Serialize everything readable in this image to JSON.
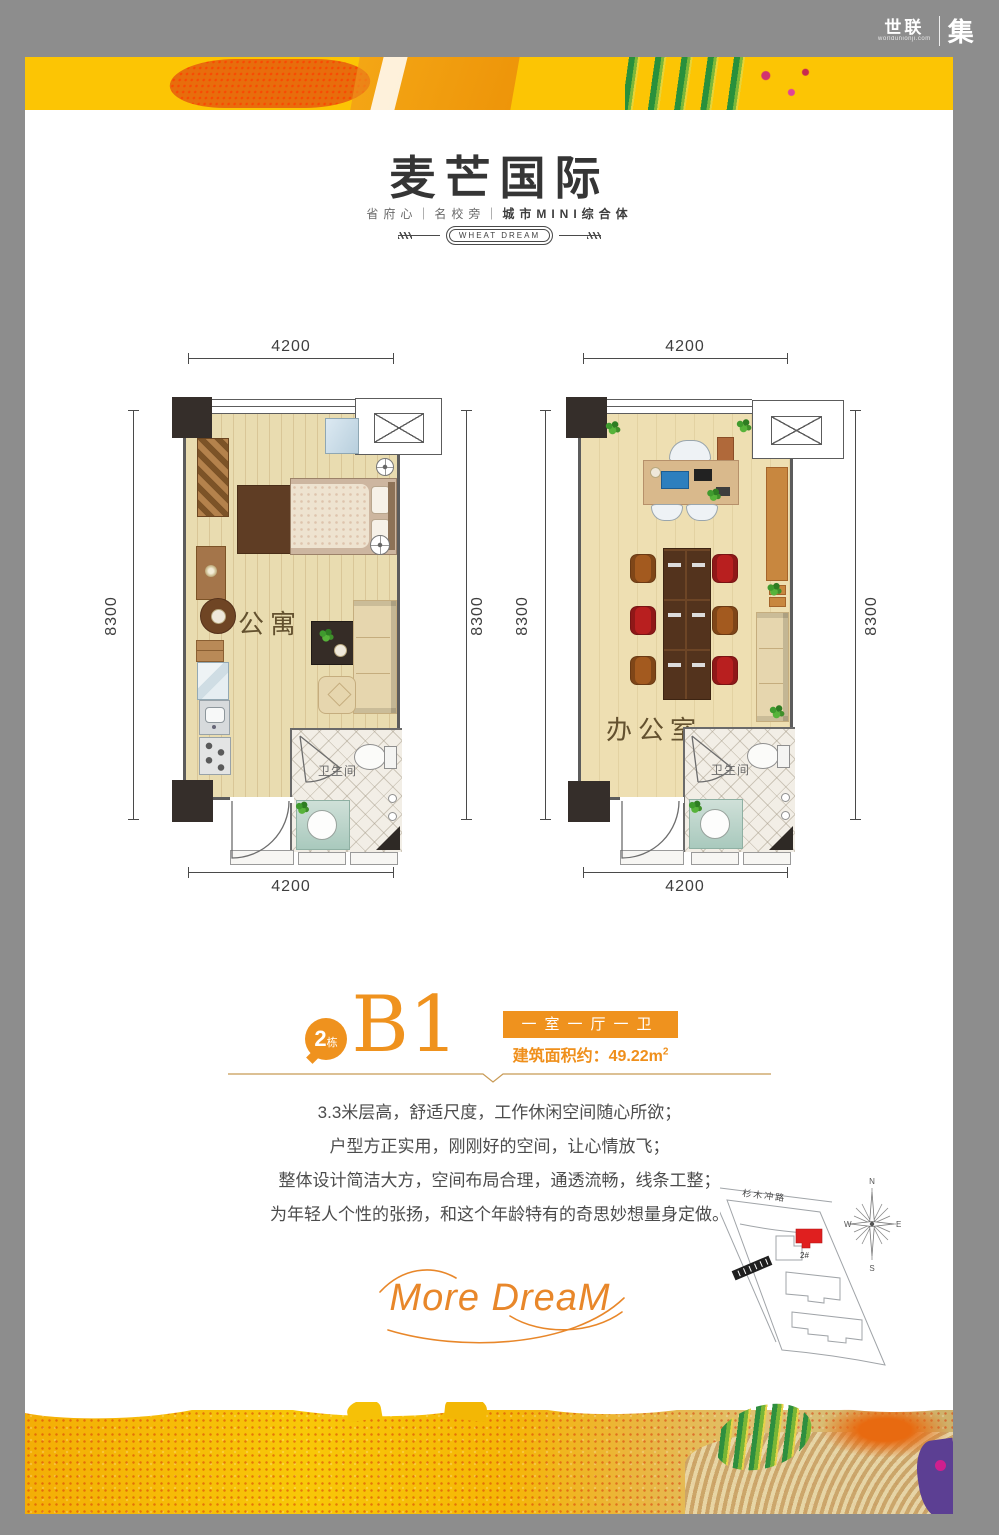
{
  "brand": {
    "corner": {
      "cn": "世联",
      "domain": "worldunionji.com",
      "suffix": "集"
    },
    "title": "麦芒国际",
    "subtitle_left": "省府心｜名校旁｜",
    "subtitle_right": "城市MINI综合体",
    "badge": "WHEAT DREAM",
    "slogan_script": "More DreaM"
  },
  "plans": {
    "left": {
      "room_label": "公寓",
      "bath_label": "卫生间",
      "dim_top": "4200",
      "dim_bottom": "4200",
      "dim_left": "8300",
      "dim_right": "8300"
    },
    "right": {
      "room_label": "办公室",
      "bath_label": "卫生间",
      "dim_top": "4200",
      "dim_bottom": "4200",
      "dim_left": "8300",
      "dim_right": "8300"
    }
  },
  "unit": {
    "building_number": "2",
    "building_suffix": "栋",
    "name": "B1",
    "layout_tag": "一室一厅一卫",
    "area_prefix": "建筑面积约：",
    "area_value": "49.22m",
    "area_sup": "2"
  },
  "description": {
    "lines": [
      "3.3米层高，舒适尺度，工作休闲空间随心所欲；",
      "户型方正实用，刚刚好的空间，让心情放飞；",
      "整体设计简洁大方，空间布局合理，通透流畅，线条工整；",
      "为年轻人个性的张扬，和这个年龄特有的奇思妙想量身定做。"
    ]
  },
  "sitemap": {
    "road_top": "杉木冲路",
    "building_tag": "2#",
    "compass_n": "N",
    "compass_w": "W",
    "compass_e": "E",
    "compass_s": "S"
  },
  "colors": {
    "accent": "#ef921e",
    "banner_yellow": "#fcc504",
    "frame_gray": "#8d8d8d",
    "red_building": "#e01f1f"
  }
}
